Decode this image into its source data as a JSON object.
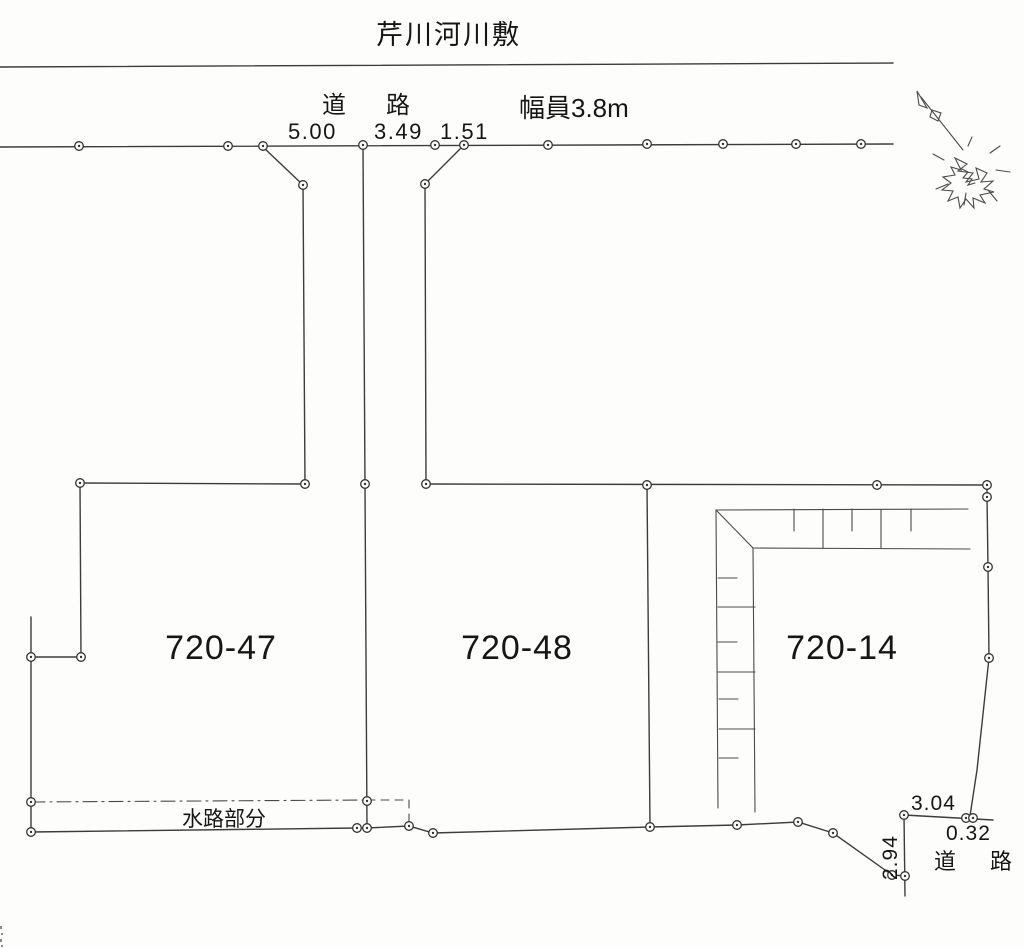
{
  "map": {
    "title": "芹川河川敷",
    "top_road": {
      "label": "道　路",
      "width_label": "幅員3.8m",
      "dims": [
        "5.00",
        "3.49",
        "1.51"
      ]
    },
    "parcels": [
      {
        "id": "720-47"
      },
      {
        "id": "720-48"
      },
      {
        "id": "720-14"
      }
    ],
    "waterway": {
      "label": "水路部分"
    },
    "bottom_road": {
      "label": "道　路",
      "dim_top": "3.04",
      "dim_right": "0.32",
      "dim_vertical": "2.94"
    },
    "compass": {
      "icon": "north-arrow"
    },
    "colors": {
      "line": "#3c3c3c",
      "text": "#161616",
      "paper": "#fdfdfc"
    }
  }
}
